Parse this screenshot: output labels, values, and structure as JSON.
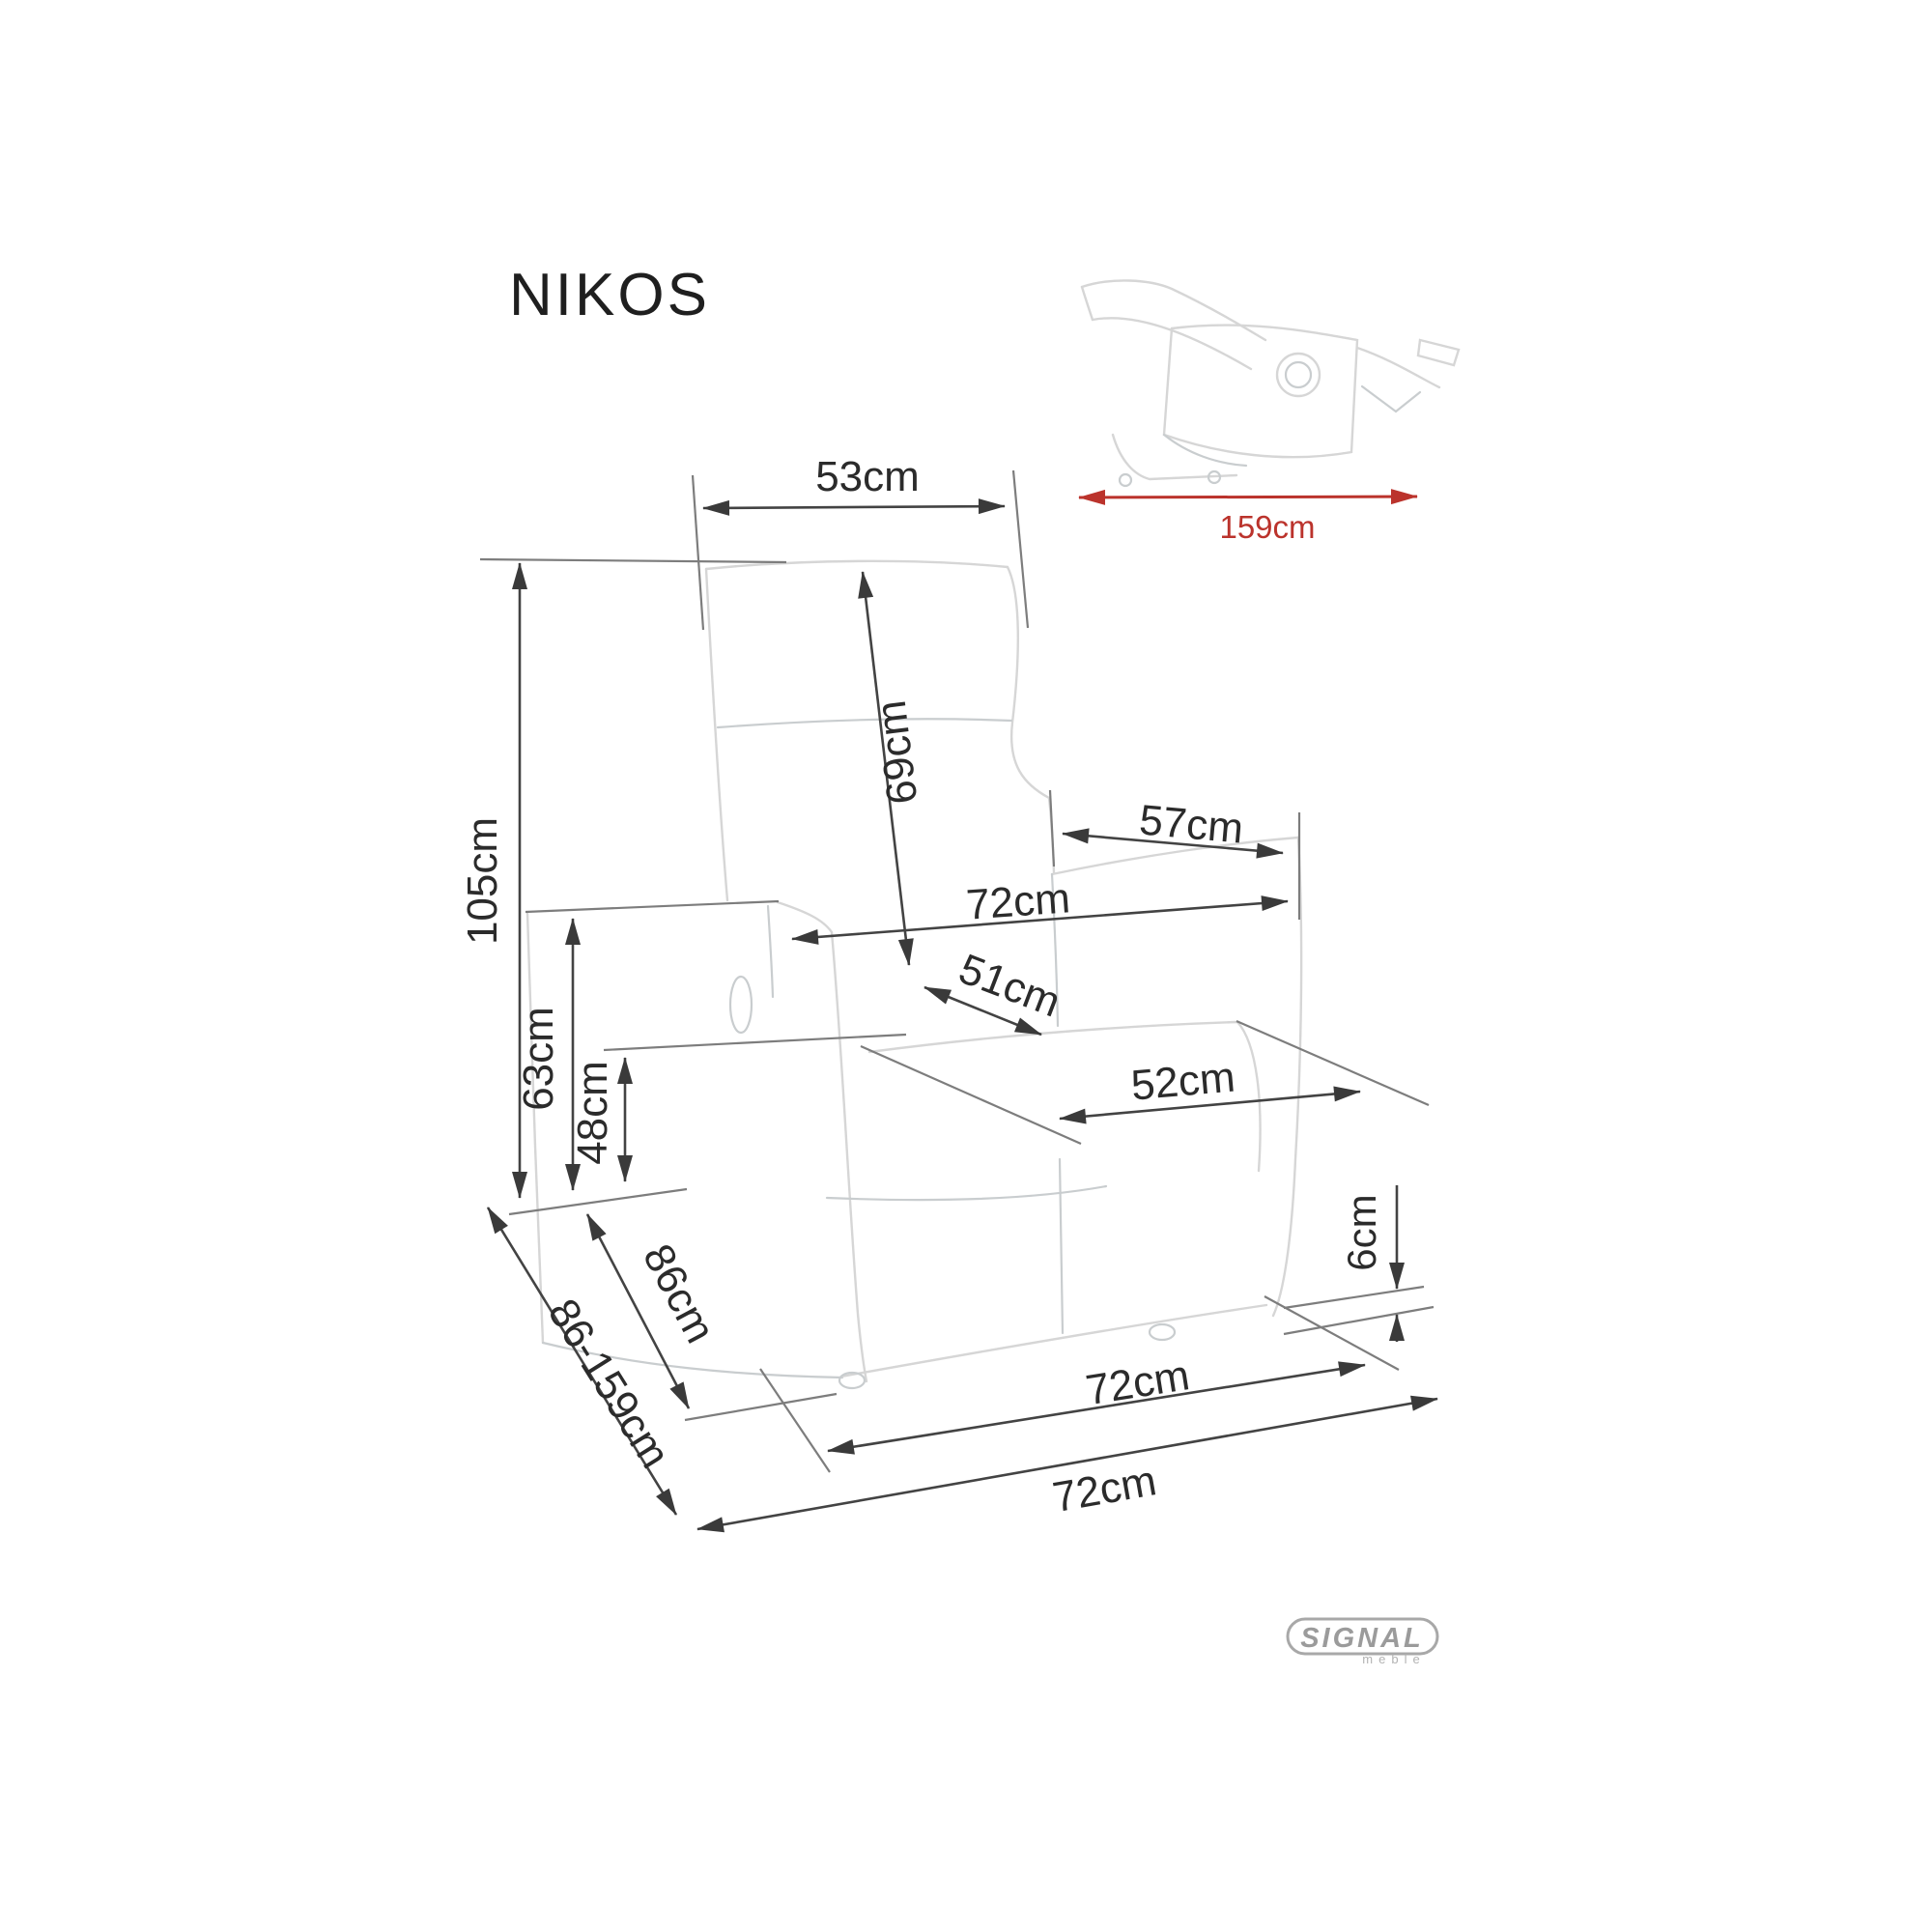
{
  "header": {
    "title": "NIKOS"
  },
  "inset": {
    "reclined_length": "159cm"
  },
  "dimensions": {
    "backrest_top_width": "53cm",
    "backrest_height": "69cm",
    "overall_height": "105cm",
    "armrest_depth": "57cm",
    "overall_width_mid": "72cm",
    "seat_depth": "51cm",
    "armrest_height": "63cm",
    "seat_height": "48cm",
    "seat_width": "52cm",
    "ground_clearance": "6cm",
    "chair_depth": "86cm",
    "depth_range": "86-159cm",
    "base_depth": "72cm",
    "overall_depth": "72cm"
  },
  "logo": {
    "brand": "SIGNAL",
    "sub": "meble"
  },
  "colors": {
    "accent_red": "#bb332c",
    "dimension_line": "#434343",
    "ghost_outline": "#d6d6d6"
  }
}
